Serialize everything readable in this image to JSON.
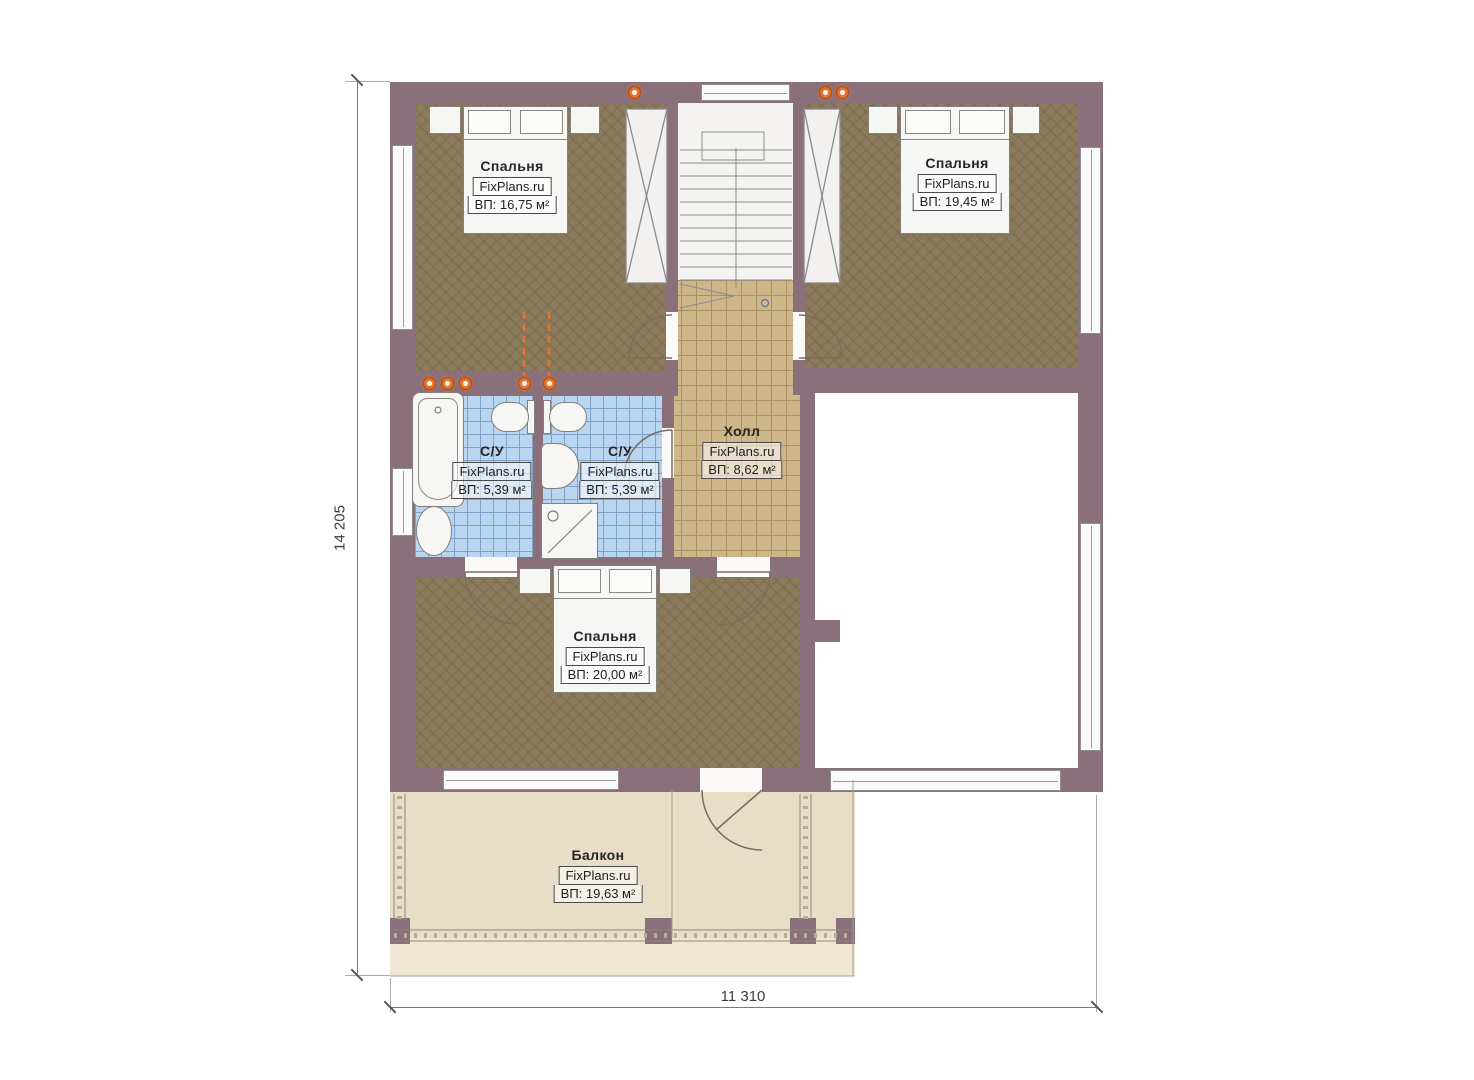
{
  "watermark": "FixPlans.ru",
  "dimensions": {
    "vertical": "14 205",
    "horizontal": "11 310"
  },
  "rooms": [
    {
      "id": "bedroom-top-left",
      "name": "Спальня",
      "watermark": "FixPlans.ru",
      "area": "ВП: 16,75 м²"
    },
    {
      "id": "bedroom-top-right",
      "name": "Спальня",
      "watermark": "FixPlans.ru",
      "area": "ВП: 19,45 м²"
    },
    {
      "id": "bathroom-left",
      "name": "С/У",
      "watermark": "FixPlans.ru",
      "area": "ВП: 5,39 м²"
    },
    {
      "id": "bathroom-right",
      "name": "С/У",
      "watermark": "FixPlans.ru",
      "area": "ВП: 5,39 м²"
    },
    {
      "id": "hall",
      "name": "Холл",
      "watermark": "FixPlans.ru",
      "area": "ВП: 8,62 м²"
    },
    {
      "id": "bedroom-bottom",
      "name": "Спальня",
      "watermark": "FixPlans.ru",
      "area": "ВП: 20,00 м²"
    },
    {
      "id": "balcony",
      "name": "Балкон",
      "watermark": "FixPlans.ru",
      "area": "ВП: 19,63 м²"
    }
  ],
  "colors": {
    "wall": "#8a707a",
    "bedroom_floor": "#8b7a5c",
    "hall_floor": "#cdb68a",
    "bathroom_floor": "#b9d5ef",
    "balcony_floor": "#e8ddc6",
    "accent_orange": "#e0762f"
  }
}
